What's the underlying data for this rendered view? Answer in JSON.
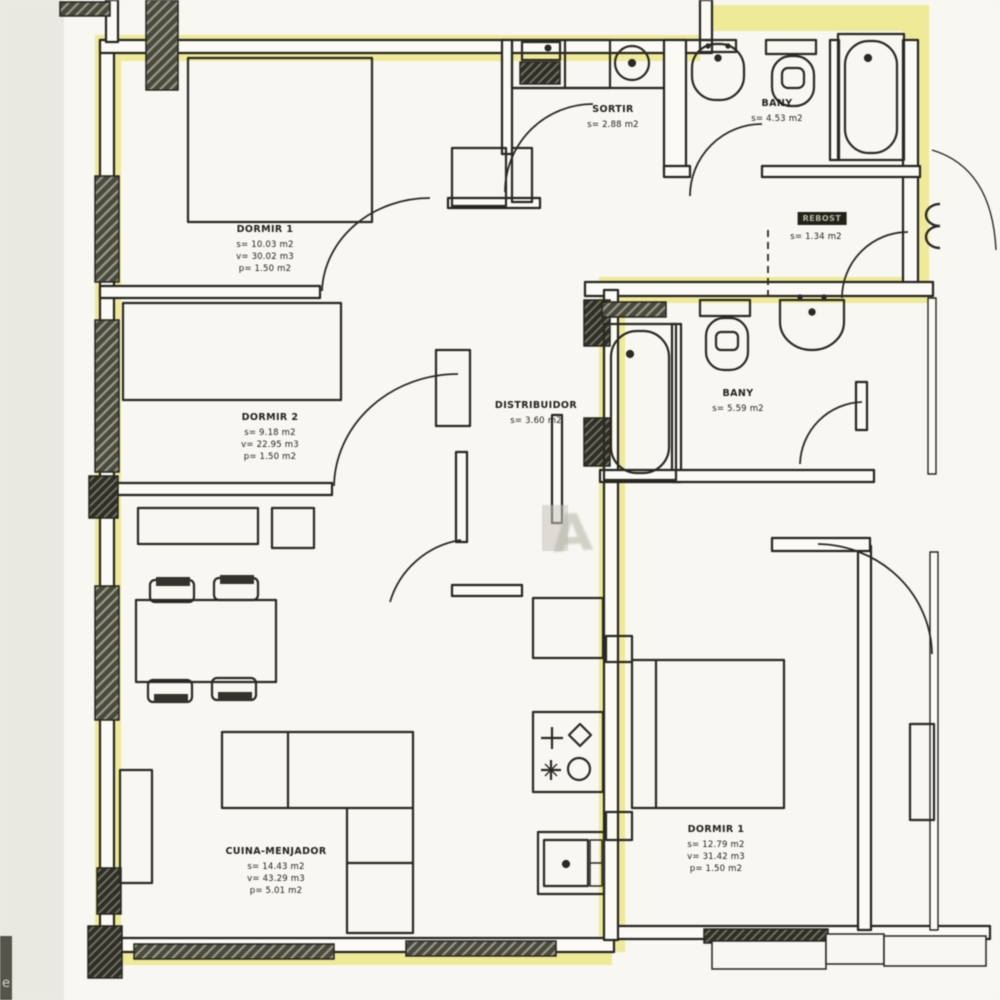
{
  "colors": {
    "highlight": "#ebe682",
    "paper": "#f8f7f1",
    "line": "#262520"
  },
  "rooms": {
    "dormir1_left": {
      "name": "DORMIR 1",
      "metrics": [
        "s= 10.03 m2",
        "v= 30.02 m3",
        "p= 1.50 m2"
      ]
    },
    "dormir2_left": {
      "name": "DORMIR 2",
      "metrics": [
        "s= 9.18 m2",
        "v= 22.95 m3",
        "p= 1.50 m2"
      ]
    },
    "sortir": {
      "name": "SORTIR",
      "metrics": [
        "s= 2.88 m2"
      ]
    },
    "bany_top": {
      "name": "BANY",
      "metrics": [
        "s= 4.53 m2"
      ]
    },
    "rebost": {
      "name": "REBOST",
      "metrics": [
        "s= 1.34 m2"
      ]
    },
    "distribuidor": {
      "name": "DISTRIBUIDOR",
      "metrics": [
        "s= 3.60 m2"
      ]
    },
    "cuina_menjador": {
      "name": "CUINA-MENJADOR",
      "metrics": [
        "s= 14.43 m2",
        "v= 43.29 m3",
        "p= 5.01 m2"
      ]
    },
    "bany_right": {
      "name": "BANY",
      "metrics": [
        "s= 5.59 m2"
      ]
    },
    "dormir1_right": {
      "name": "DORMIR 1",
      "metrics": [
        "s= 12.79 m2",
        "v= 31.42 m3",
        "p= 1.50 m2"
      ]
    }
  },
  "marks": {
    "corner": "e",
    "watermark": "A"
  }
}
